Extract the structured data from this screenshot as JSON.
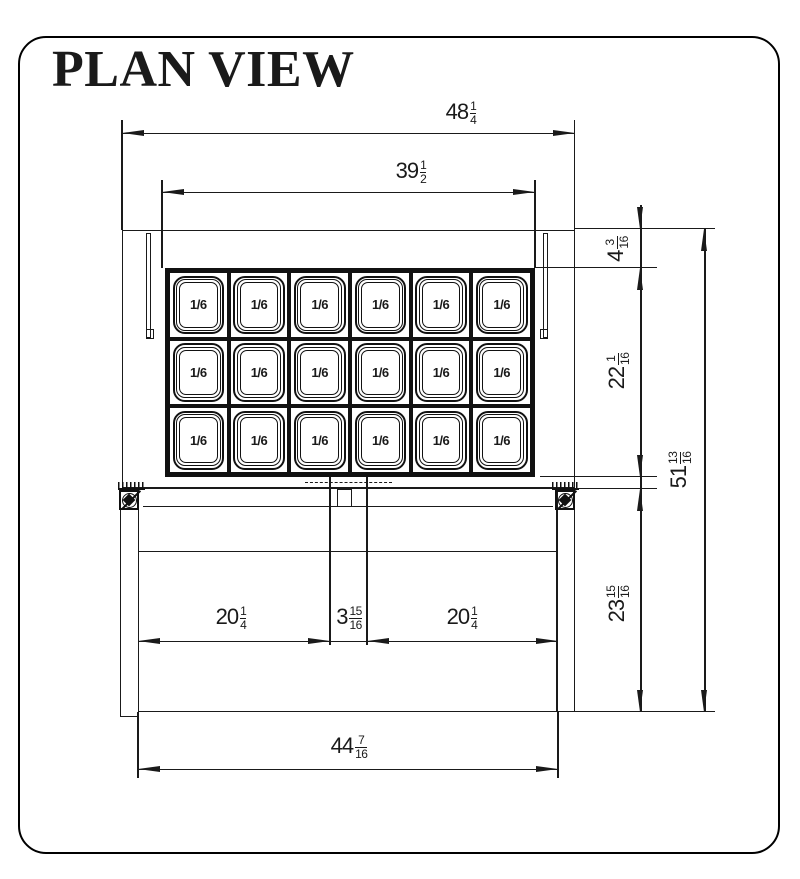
{
  "title": "PLAN VIEW",
  "colors": {
    "line": "#1a1a1a",
    "background": "#ffffff"
  },
  "tray": {
    "rows": 3,
    "cols": 6,
    "pan_label": "1/6",
    "pan_count": 18
  },
  "dims": {
    "overall_width": {
      "whole": "48",
      "num": "1",
      "den": "4"
    },
    "pan_rail_width": {
      "whole": "39",
      "num": "1",
      "den": "2"
    },
    "rear_to_pan_offset": {
      "whole": "4",
      "num": "3",
      "den": "16"
    },
    "pan_section_depth": {
      "whole": "22",
      "num": "1",
      "den": "16"
    },
    "overall_depth": {
      "whole": "51",
      "num": "13",
      "den": "16"
    },
    "front_section_depth": {
      "whole": "23",
      "num": "15",
      "den": "16"
    },
    "left_door_width": {
      "whole": "20",
      "num": "1",
      "den": "4"
    },
    "center_divider_width": {
      "whole": "3",
      "num": "15",
      "den": "16"
    },
    "right_door_width": {
      "whole": "20",
      "num": "1",
      "den": "4"
    },
    "front_width": {
      "whole": "44",
      "num": "7",
      "den": "16"
    }
  }
}
